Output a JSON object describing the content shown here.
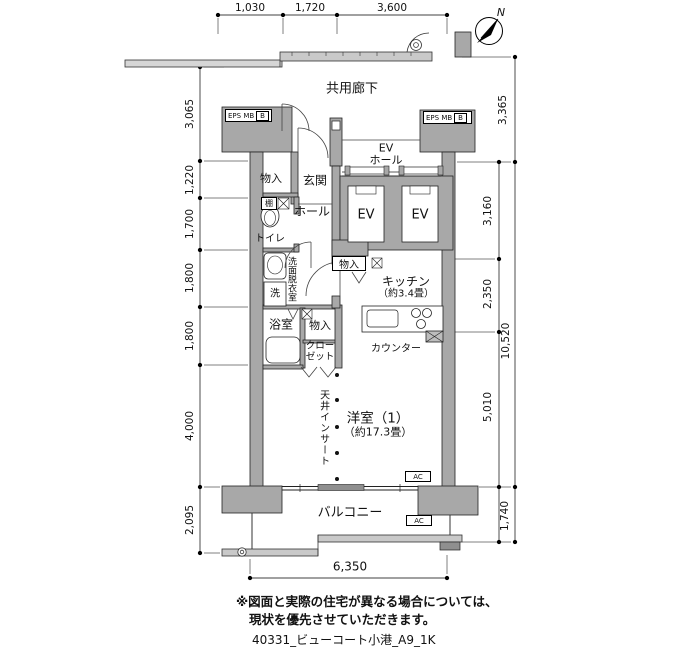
{
  "title_block": {
    "drawing_id": "40331_ビューコート小港_A9_1K"
  },
  "disclaimer": {
    "line1": "※図面と実際の住宅が異なる場合については、",
    "line2": "現状を優先させていただきます。"
  },
  "compass": {
    "north_label": "N"
  },
  "dimensions": {
    "top": [
      "1,030",
      "1,720",
      "3,600"
    ],
    "left": [
      "3,065",
      "1,220",
      "1,700",
      "1,800",
      "1,800",
      "4,000",
      "2,095"
    ],
    "right": [
      "3,365",
      "3,160",
      "2,350",
      "10,520",
      "5,010",
      "1,740"
    ],
    "bottom": [
      "6,350"
    ]
  },
  "common_areas": {
    "corridor": "共用廊下",
    "ev_hall_line1": "EV",
    "ev_hall_line2": "ホール",
    "ev_left": "EV",
    "ev_right": "EV",
    "eps_left": "EPS MB",
    "eps_left_b": "B",
    "eps_right": "EPS MB",
    "eps_right_b": "B"
  },
  "rooms": {
    "entrance": "玄関",
    "hall": "ホール",
    "storage_entrance": "物入",
    "shelf": "棚",
    "toilet": "トイレ",
    "washroom": "洗面脱衣室",
    "washer": "洗",
    "bath": "浴室",
    "storage_mid": "物入",
    "closet_line1": "クロー",
    "closet_line2": "ゼット",
    "storage_kitchen": "物入",
    "kitchen_line1": "キッチン",
    "kitchen_line2": "（約3.4畳）",
    "counter": "カウンター",
    "ceiling_insert": "天井インサート",
    "main_room_line1": "洋室（1）",
    "main_room_line2": "（約17.3畳）",
    "balcony": "バルコニー",
    "ac_upper": "AC",
    "ac_lower": "AC"
  },
  "colors": {
    "wall_fill": "#a8a8a8",
    "railing_fill": "#c9c9c9",
    "line": "#1a1a1a"
  }
}
